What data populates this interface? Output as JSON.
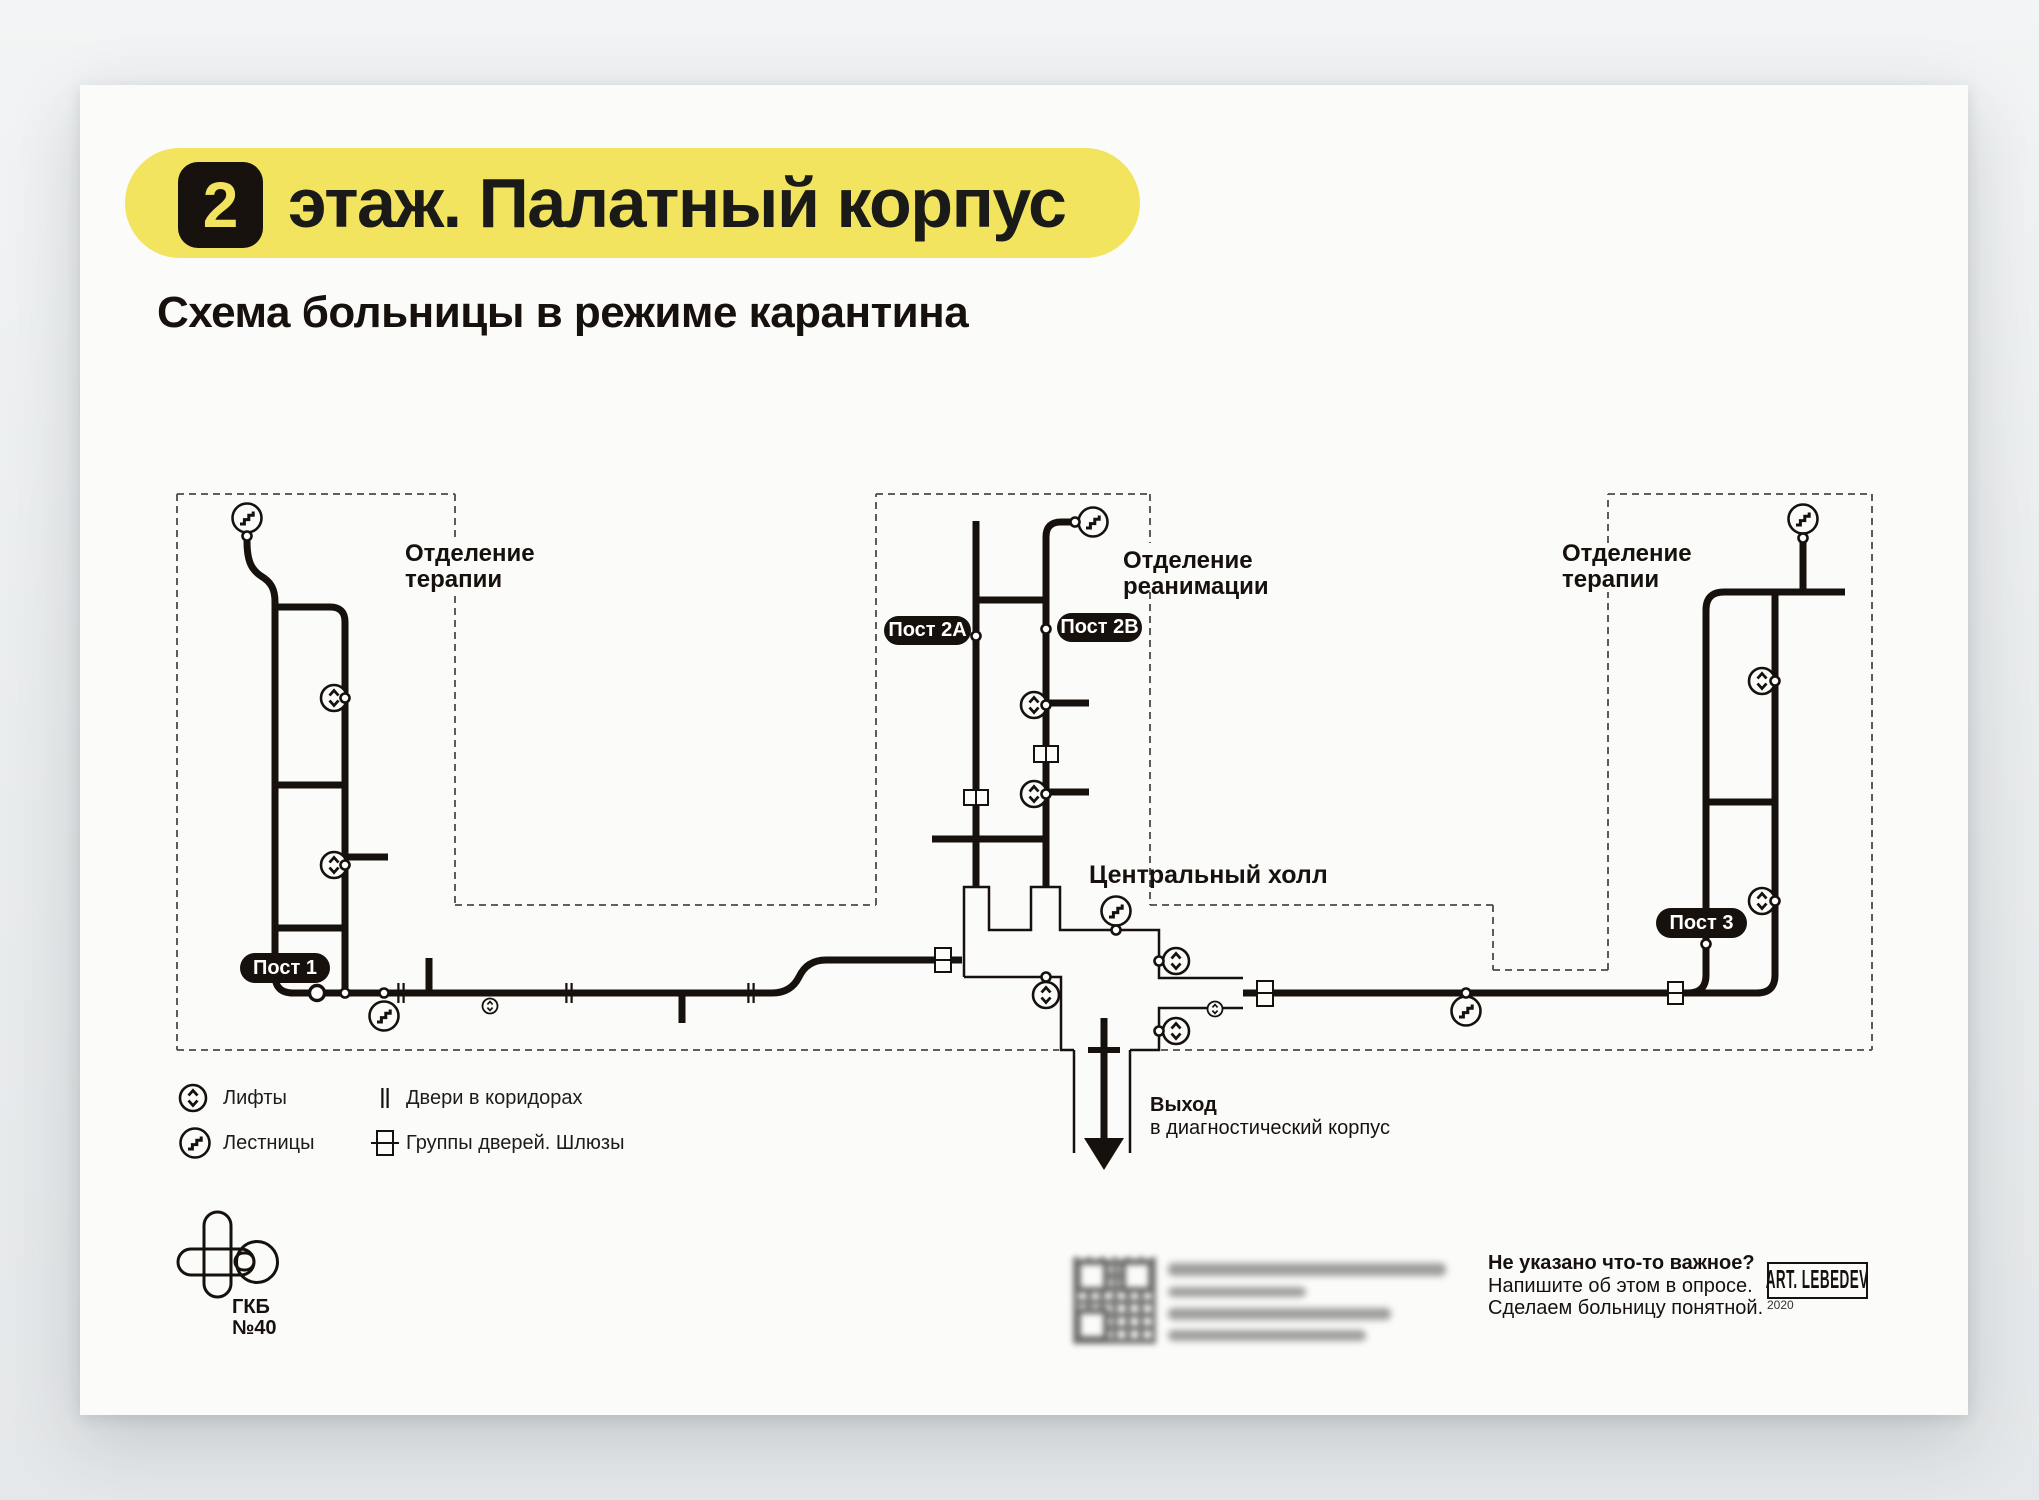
{
  "header": {
    "floor_badge": "2",
    "title": "этаж. Палатный корпус",
    "subtitle": "Схема больницы в режиме карантина"
  },
  "diagram": {
    "departments": [
      {
        "line1": "Отделение",
        "line2": "терапии"
      },
      {
        "line1": "Отделение",
        "line2": "реанимации"
      },
      {
        "line1": "Отделение",
        "line2": "терапии"
      }
    ],
    "central_hall": "Центральный холл",
    "posts": [
      {
        "label": "Пост 1"
      },
      {
        "label": "Пост 2А"
      },
      {
        "label": "Пост 2В"
      },
      {
        "label": "Пост 3"
      }
    ],
    "exit": {
      "line1": "Выход",
      "line2": "в диагностический корпус"
    }
  },
  "legend": {
    "items": [
      {
        "icon": "elevator-icon",
        "label": "Лифты"
      },
      {
        "icon": "stairs-icon",
        "label": "Лестницы"
      },
      {
        "icon": "corridor-doors-icon",
        "label": "Двери в коридорах"
      },
      {
        "icon": "airlock-icon",
        "label": "Группы дверей. Шлюзы"
      }
    ]
  },
  "footer": {
    "hospital": {
      "abbr": "ГКБ",
      "number": "№40"
    },
    "note": {
      "line1": "Не указано что-то важное?",
      "line2": "Напишите об этом в опросе.",
      "line3": "Сделаем больницу понятной."
    },
    "studio": {
      "name": "ART. LEBEDEV",
      "year": "2020"
    }
  },
  "colors": {
    "paper": "#FBFBF9",
    "background": "#E9ECED",
    "ink": "#16110D",
    "accent_yellow": "#F2E45F",
    "dashed_gray": "#4A4A4A"
  }
}
